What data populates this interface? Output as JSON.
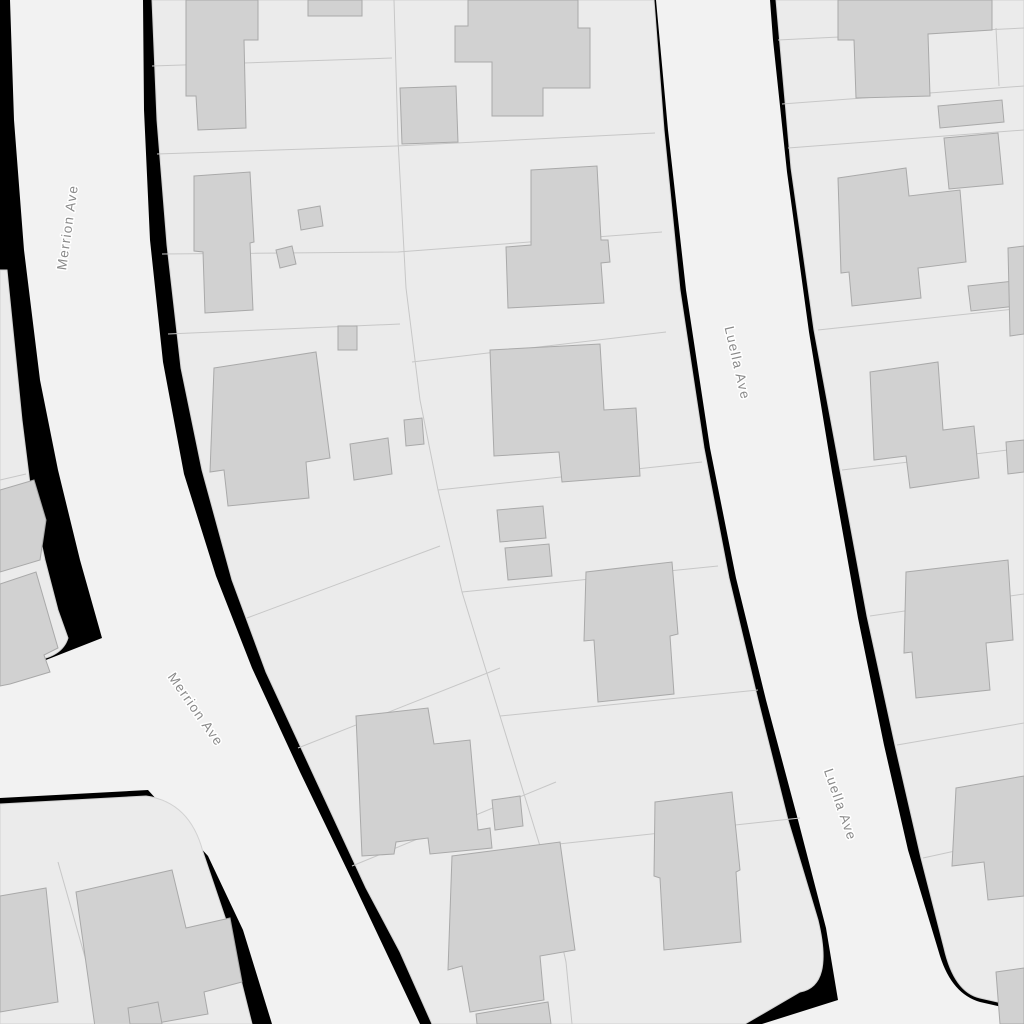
{
  "map": {
    "canvas": {
      "width": 1024,
      "height": 1024
    },
    "colors": {
      "background": "#000000",
      "road_fill": "#f2f2f2",
      "parcel_fill": "#ebebeb",
      "parcel_edge": "#d2d2d2",
      "parcel_line": "#c7c7c7",
      "building_fill": "#d1d1d1",
      "building_edge": "#a9a9a9",
      "label_text": "#8a8a8a",
      "label_halo": "#ffffff"
    },
    "streets": [
      {
        "name": "Merrion Ave"
      },
      {
        "name": "Luella Ave"
      }
    ],
    "labels": [
      {
        "text": "Merrion Ave",
        "x": 72,
        "y": 228,
        "rotation": -82,
        "street": "merrion-ave"
      },
      {
        "text": "Merrion Ave",
        "x": 192,
        "y": 712,
        "rotation": 55,
        "street": "merrion-ave"
      },
      {
        "text": "Luella Ave",
        "x": 733,
        "y": 364,
        "rotation": 77,
        "street": "luella-ave"
      },
      {
        "text": "Luella Ave",
        "x": 836,
        "y": 806,
        "rotation": 71,
        "street": "luella-ave"
      }
    ],
    "roads": [
      {
        "id": "merrion-ave-road",
        "d": "M 10 0 L 143 0 L 144 110 L 150 240 L 163 362 L 184 474 L 216 576 L 252 668 L 300 772 L 352 880 L 420 1024 L 272 1024 L 243 930 L 208 856 L 148 790 L 0 798 L 0 678 L 102 638 L 80 560 L 58 470 L 40 380 L 24 250 L 14 120 Z"
      },
      {
        "id": "luella-ave-road",
        "d": "M 656 0 L 770 0 L 773 40 L 787 172 L 809 332 L 832 472 L 858 618 L 884 745 L 908 850 L 940 956 Q 952 994 980 1002 L 1024 1012 L 1024 1024 L 762 1024 L 838 1000 L 826 928 L 798 820 L 766 700 L 736 578 L 710 448 L 686 290 L 668 130 Z"
      }
    ],
    "parcels": [
      {
        "id": "block-west-strip",
        "d": "M 0 270 L 7 270 L 13 330 L 22 420 L 32 500 L 45 560 L 58 610 L 68 638 Q 62 658 30 661 L 0 666 Z"
      },
      {
        "id": "block-central",
        "d": "M 152 0 L 157 120 L 167 245 L 181 368 L 202 470 L 232 580 L 266 672 L 315 778 L 366 888 L 400 952 L 432 1024 L 745 1024 L 800 992 Q 834 986 818 920 L 788 820 L 758 700 L 729 578 L 704 448 L 680 290 L 664 130 L 654 0 Z"
      },
      {
        "id": "block-east",
        "d": "M 776 0 L 791 168 L 814 330 L 840 470 L 867 616 L 895 745 L 921 858 L 944 948 Q 954 992 980 998 L 1024 1008 L 1024 0 Z"
      },
      {
        "id": "block-southwest",
        "d": "M 0 804 L 146 796 Q 190 802 203 852 L 226 920 L 252 1024 L 0 1024 Z"
      }
    ],
    "parcel_lines": [
      [
        [
          152,
          66
        ],
        [
          392,
          58
        ]
      ],
      [
        [
          157,
          154
        ],
        [
          396,
          146
        ],
        [
          655,
          133
        ]
      ],
      [
        [
          162,
          254
        ],
        [
          398,
          252
        ],
        [
          662,
          232
        ]
      ],
      [
        [
          168,
          334
        ],
        [
          400,
          324
        ]
      ],
      [
        [
          412,
          362
        ],
        [
          666,
          332
        ]
      ],
      [
        [
          247,
          618
        ],
        [
          440,
          546
        ]
      ],
      [
        [
          298,
          748
        ],
        [
          500,
          668
        ]
      ],
      [
        [
          352,
          866
        ],
        [
          556,
          782
        ]
      ],
      [
        [
          394,
          0
        ],
        [
          398,
          140
        ],
        [
          406,
          288
        ],
        [
          420,
          400
        ],
        [
          438,
          490
        ],
        [
          462,
          592
        ],
        [
          500,
          716
        ],
        [
          540,
          846
        ],
        [
          566,
          962
        ],
        [
          572,
          1024
        ]
      ],
      [
        [
          438,
          490
        ],
        [
          702,
          462
        ]
      ],
      [
        [
          462,
          592
        ],
        [
          718,
          566
        ]
      ],
      [
        [
          500,
          716
        ],
        [
          758,
          690
        ]
      ],
      [
        [
          540,
          846
        ],
        [
          800,
          818
        ]
      ],
      [
        [
          778,
          40
        ],
        [
          1024,
          28
        ]
      ],
      [
        [
          782,
          104
        ],
        [
          1024,
          86
        ]
      ],
      [
        [
          788,
          148
        ],
        [
          1024,
          130
        ]
      ],
      [
        [
          818,
          330
        ],
        [
          1024,
          308
        ]
      ],
      [
        [
          842,
          470
        ],
        [
          1024,
          448
        ]
      ],
      [
        [
          870,
          616
        ],
        [
          1024,
          594
        ]
      ],
      [
        [
          897,
          745
        ],
        [
          1024,
          723
        ]
      ],
      [
        [
          923,
          858
        ],
        [
          1024,
          836
        ]
      ],
      [
        [
          996,
          28
        ],
        [
          999,
          86
        ]
      ],
      [
        [
          58,
          862
        ],
        [
          104,
          1024
        ]
      ],
      [
        [
          0,
          480
        ],
        [
          26,
          474
        ]
      ]
    ],
    "buildings": [
      [
        [
          186,
          0
        ],
        [
          258,
          0
        ],
        [
          258,
          40
        ],
        [
          244,
          40
        ],
        [
          246,
          128
        ],
        [
          198,
          130
        ],
        [
          196,
          96
        ],
        [
          186,
          96
        ]
      ],
      [
        [
          308,
          0
        ],
        [
          362,
          0
        ],
        [
          362,
          16
        ],
        [
          308,
          16
        ]
      ],
      [
        [
          468,
          0
        ],
        [
          578,
          0
        ],
        [
          578,
          28
        ],
        [
          590,
          28
        ],
        [
          590,
          88
        ],
        [
          543,
          88
        ],
        [
          543,
          116
        ],
        [
          492,
          116
        ],
        [
          492,
          62
        ],
        [
          455,
          62
        ],
        [
          455,
          26
        ],
        [
          468,
          26
        ]
      ],
      [
        [
          400,
          88
        ],
        [
          456,
          86
        ],
        [
          458,
          142
        ],
        [
          402,
          144
        ]
      ],
      [
        [
          194,
          176
        ],
        [
          250,
          172
        ],
        [
          254,
          242
        ],
        [
          250,
          243
        ],
        [
          253,
          310
        ],
        [
          205,
          313
        ],
        [
          203,
          252
        ],
        [
          194,
          251
        ]
      ],
      [
        [
          298,
          210
        ],
        [
          320,
          206
        ],
        [
          323,
          226
        ],
        [
          301,
          230
        ]
      ],
      [
        [
          276,
          250
        ],
        [
          292,
          246
        ],
        [
          296,
          264
        ],
        [
          280,
          268
        ]
      ],
      [
        [
          531,
          170
        ],
        [
          597,
          166
        ],
        [
          601,
          240
        ],
        [
          608,
          240
        ],
        [
          610,
          262
        ],
        [
          601,
          263
        ],
        [
          604,
          303
        ],
        [
          508,
          308
        ],
        [
          506,
          247
        ],
        [
          531,
          245
        ]
      ],
      [
        [
          338,
          326
        ],
        [
          357,
          326
        ],
        [
          357,
          350
        ],
        [
          338,
          350
        ]
      ],
      [
        [
          214,
          368
        ],
        [
          316,
          352
        ],
        [
          330,
          458
        ],
        [
          306,
          462
        ],
        [
          309,
          498
        ],
        [
          228,
          506
        ],
        [
          224,
          470
        ],
        [
          210,
          472
        ]
      ],
      [
        [
          350,
          444
        ],
        [
          388,
          438
        ],
        [
          392,
          474
        ],
        [
          354,
          480
        ]
      ],
      [
        [
          404,
          420
        ],
        [
          422,
          418
        ],
        [
          424,
          444
        ],
        [
          406,
          446
        ]
      ],
      [
        [
          490,
          350
        ],
        [
          600,
          344
        ],
        [
          604,
          410
        ],
        [
          636,
          408
        ],
        [
          640,
          476
        ],
        [
          562,
          482
        ],
        [
          559,
          452
        ],
        [
          494,
          456
        ]
      ],
      [
        [
          497,
          510
        ],
        [
          543,
          506
        ],
        [
          546,
          538
        ],
        [
          500,
          542
        ]
      ],
      [
        [
          505,
          548
        ],
        [
          549,
          544
        ],
        [
          552,
          576
        ],
        [
          508,
          580
        ]
      ],
      [
        [
          586,
          572
        ],
        [
          672,
          562
        ],
        [
          678,
          634
        ],
        [
          670,
          636
        ],
        [
          674,
          694
        ],
        [
          598,
          702
        ],
        [
          594,
          640
        ],
        [
          584,
          641
        ]
      ],
      [
        [
          655,
          802
        ],
        [
          732,
          792
        ],
        [
          740,
          870
        ],
        [
          736,
          872
        ],
        [
          741,
          942
        ],
        [
          664,
          950
        ],
        [
          660,
          878
        ],
        [
          654,
          876
        ]
      ],
      [
        [
          356,
          716
        ],
        [
          428,
          708
        ],
        [
          434,
          744
        ],
        [
          470,
          740
        ],
        [
          478,
          830
        ],
        [
          490,
          828
        ],
        [
          492,
          848
        ],
        [
          430,
          854
        ],
        [
          428,
          838
        ],
        [
          396,
          842
        ],
        [
          394,
          854
        ],
        [
          362,
          856
        ]
      ],
      [
        [
          492,
          800
        ],
        [
          520,
          796
        ],
        [
          523,
          826
        ],
        [
          495,
          830
        ]
      ],
      [
        [
          452,
          856
        ],
        [
          560,
          842
        ],
        [
          575,
          950
        ],
        [
          540,
          956
        ],
        [
          544,
          1000
        ],
        [
          470,
          1012
        ],
        [
          462,
          966
        ],
        [
          448,
          970
        ]
      ],
      [
        [
          476,
          1014
        ],
        [
          548,
          1002
        ],
        [
          551,
          1024
        ],
        [
          477,
          1024
        ]
      ],
      [
        [
          76,
          892
        ],
        [
          172,
          870
        ],
        [
          186,
          928
        ],
        [
          230,
          918
        ],
        [
          242,
          982
        ],
        [
          204,
          992
        ],
        [
          208,
          1014
        ],
        [
          96,
          1034
        ]
      ],
      [
        [
          0,
          896
        ],
        [
          46,
          888
        ],
        [
          58,
          1002
        ],
        [
          0,
          1012
        ]
      ],
      [
        [
          128,
          1008
        ],
        [
          158,
          1002
        ],
        [
          162,
          1024
        ],
        [
          130,
          1024
        ]
      ],
      [
        [
          0,
          490
        ],
        [
          34,
          480
        ],
        [
          46,
          520
        ],
        [
          40,
          560
        ],
        [
          0,
          572
        ]
      ],
      [
        [
          0,
          584
        ],
        [
          36,
          572
        ],
        [
          58,
          648
        ],
        [
          44,
          655
        ],
        [
          50,
          672
        ],
        [
          10,
          684
        ],
        [
          0,
          686
        ]
      ],
      [
        [
          838,
          0
        ],
        [
          992,
          0
        ],
        [
          992,
          30
        ],
        [
          928,
          34
        ],
        [
          930,
          96
        ],
        [
          856,
          98
        ],
        [
          854,
          40
        ],
        [
          838,
          40
        ]
      ],
      [
        [
          938,
          106
        ],
        [
          1002,
          100
        ],
        [
          1004,
          122
        ],
        [
          940,
          128
        ]
      ],
      [
        [
          944,
          138
        ],
        [
          998,
          133
        ],
        [
          1003,
          184
        ],
        [
          949,
          189
        ]
      ],
      [
        [
          838,
          178
        ],
        [
          906,
          168
        ],
        [
          909,
          196
        ],
        [
          960,
          190
        ],
        [
          966,
          262
        ],
        [
          918,
          268
        ],
        [
          921,
          298
        ],
        [
          852,
          306
        ],
        [
          849,
          272
        ],
        [
          841,
          273
        ]
      ],
      [
        [
          968,
          286
        ],
        [
          1014,
          281
        ],
        [
          1017,
          306
        ],
        [
          971,
          311
        ]
      ],
      [
        [
          1008,
          248
        ],
        [
          1024,
          246
        ],
        [
          1024,
          334
        ],
        [
          1010,
          336
        ]
      ],
      [
        [
          870,
          372
        ],
        [
          938,
          362
        ],
        [
          943,
          430
        ],
        [
          974,
          426
        ],
        [
          979,
          478
        ],
        [
          910,
          488
        ],
        [
          906,
          456
        ],
        [
          874,
          460
        ]
      ],
      [
        [
          1006,
          442
        ],
        [
          1024,
          440
        ],
        [
          1024,
          472
        ],
        [
          1008,
          474
        ]
      ],
      [
        [
          906,
          572
        ],
        [
          1008,
          560
        ],
        [
          1013,
          640
        ],
        [
          986,
          643
        ],
        [
          990,
          690
        ],
        [
          916,
          698
        ],
        [
          912,
          652
        ],
        [
          904,
          653
        ]
      ],
      [
        [
          956,
          788
        ],
        [
          1024,
          776
        ],
        [
          1024,
          896
        ],
        [
          988,
          900
        ],
        [
          984,
          862
        ],
        [
          952,
          866
        ]
      ],
      [
        [
          996,
          972
        ],
        [
          1024,
          968
        ],
        [
          1024,
          1024
        ],
        [
          1000,
          1024
        ]
      ]
    ]
  }
}
